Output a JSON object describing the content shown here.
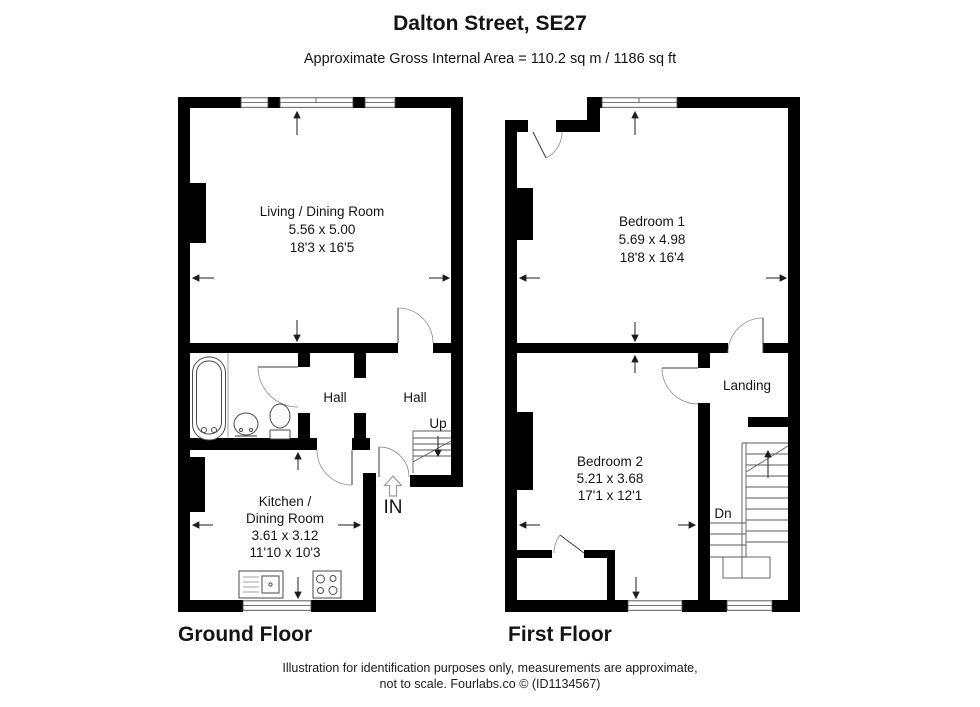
{
  "header": {
    "title": "Dalton Street, SE27",
    "subtitle": "Approximate Gross Internal Area = 110.2 sq m / 1186 sq ft"
  },
  "ground_floor": {
    "label": "Ground Floor",
    "living_room": {
      "name": "Living / Dining Room",
      "size_metric": "5.56 x 5.00",
      "size_imperial": "18'3 x 16'5"
    },
    "hall_left": "Hall",
    "hall_right": "Hall",
    "stairs_label": "Up",
    "entrance_label": "IN",
    "kitchen": {
      "name_line1": "Kitchen /",
      "name_line2": "Dining Room",
      "size_metric": "3.61 x 3.12",
      "size_imperial": "11'10 x 10'3"
    }
  },
  "first_floor": {
    "label": "First Floor",
    "bedroom1": {
      "name": "Bedroom 1",
      "size_metric": "5.69 x 4.98",
      "size_imperial": "18'8 x 16'4"
    },
    "bedroom2": {
      "name": "Bedroom 2",
      "size_metric": "5.21 x 3.68",
      "size_imperial": "17'1 x 12'1"
    },
    "landing_label": "Landing",
    "stairs_label": "Dn"
  },
  "footer": {
    "line1": "Illustration for identification purposes only, measurements are approximate,",
    "line2": "not to scale. Fourlabs.co © (ID1134567)"
  },
  "colors": {
    "wall": "#000000",
    "background": "#ffffff",
    "accent_line": "#333333"
  }
}
